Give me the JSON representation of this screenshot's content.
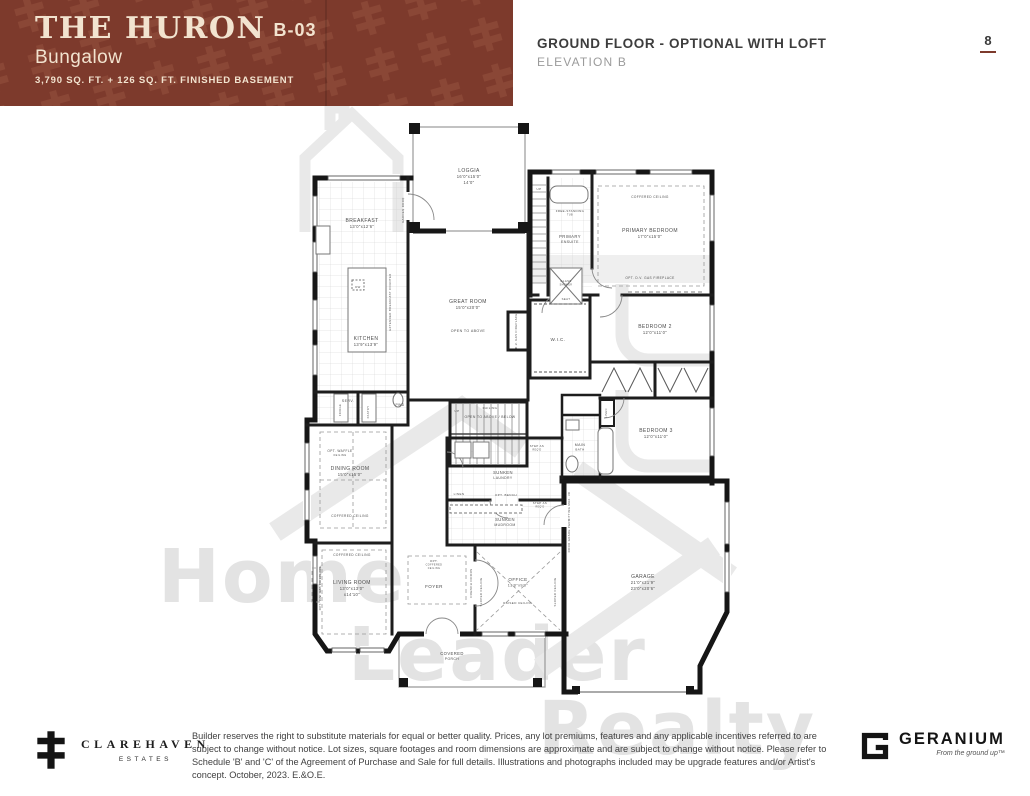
{
  "header": {
    "plan_name": "THE HURON",
    "plan_code": "B-03",
    "plan_type": "Bungalow",
    "sqft_line": "3,790 SQ. FT. + 126 SQ. FT. FINISHED BASEMENT",
    "sheet_title": "GROUND FLOOR - OPTIONAL WITH LOFT",
    "elevation": "ELEVATION B",
    "page_number": "8",
    "banner_color": "#7d3a2c"
  },
  "watermark": {
    "line1": "Home",
    "line2": "Leader",
    "line3": "Realty"
  },
  "floorplan": {
    "labels": [
      {
        "id": "loggia",
        "x": 469,
        "y": 172,
        "size": 5,
        "lines": [
          "LOGGIA",
          "16'0\"x15'0\"",
          "14'0\""
        ]
      },
      {
        "id": "garden-door",
        "x": 404,
        "y": 210,
        "size": 2.8,
        "rot": -90,
        "lines": [
          "GARDEN DOOR"
        ]
      },
      {
        "id": "breakfast",
        "x": 362,
        "y": 222,
        "size": 5,
        "lines": [
          "BREAKFAST",
          "13'0\"x12'6\""
        ]
      },
      {
        "id": "kitchen",
        "x": 366,
        "y": 340,
        "size": 5,
        "lines": [
          "KITCHEN",
          "13'9\"x13'9\""
        ]
      },
      {
        "id": "dw",
        "x": 358,
        "y": 288,
        "size": 2.8,
        "lines": [
          "DW"
        ]
      },
      {
        "id": "extended-counter",
        "x": 391,
        "y": 302,
        "size": 2.8,
        "rot": -90,
        "lines": [
          "EXTENDED BREAKFAST COUNTER"
        ]
      },
      {
        "id": "serv",
        "x": 348,
        "y": 402,
        "size": 3.6,
        "lines": [
          "SERV."
        ]
      },
      {
        "id": "fridge",
        "x": 341,
        "y": 410,
        "size": 2.6,
        "rot": -90,
        "lines": [
          "FRIDGE"
        ]
      },
      {
        "id": "pantry",
        "x": 369,
        "y": 412,
        "size": 2.6,
        "rot": -90,
        "lines": [
          "PANTRY"
        ]
      },
      {
        "id": "pwd",
        "x": 400,
        "y": 406,
        "size": 3.4,
        "lines": [
          "PWD"
        ]
      },
      {
        "id": "great-room",
        "x": 468,
        "y": 303,
        "size": 5,
        "lines": [
          "GREAT ROOM",
          "15'0\"x20'0\""
        ]
      },
      {
        "id": "open-to-above",
        "x": 468,
        "y": 332,
        "size": 3.6,
        "lines": [
          "OPEN TO ABOVE"
        ]
      },
      {
        "id": "dv-gas-fireplace",
        "x": 517,
        "y": 331,
        "size": 2.8,
        "rot": -90,
        "lines": [
          "D.V. GAS FIREPLACE"
        ]
      },
      {
        "id": "up-loft",
        "x": 539,
        "y": 190,
        "size": 3,
        "lines": [
          "UP"
        ]
      },
      {
        "id": "free-standing-tub",
        "x": 570,
        "y": 212,
        "size": 2.9,
        "lines": [
          "FREE-STANDING",
          "TUB"
        ]
      },
      {
        "id": "primary-ensuite",
        "x": 570,
        "y": 238,
        "size": 4.2,
        "lines": [
          "PRIMARY",
          "ENSUITE"
        ]
      },
      {
        "id": "glass-shower",
        "x": 566,
        "y": 282,
        "size": 2.8,
        "lines": [
          "GLASS",
          "SHOWER"
        ]
      },
      {
        "id": "seat",
        "x": 566,
        "y": 300,
        "size": 2.8,
        "lines": [
          "SEAT"
        ]
      },
      {
        "id": "coffered-primary",
        "x": 650,
        "y": 198,
        "size": 3.2,
        "lines": [
          "COFFERED CEILING"
        ]
      },
      {
        "id": "primary-bedroom",
        "x": 650,
        "y": 232,
        "size": 5,
        "lines": [
          "PRIMARY BEDROOM",
          "17'0\"x15'0\""
        ]
      },
      {
        "id": "opt-fireplace-primary",
        "x": 650,
        "y": 279,
        "size": 3.2,
        "lines": [
          "OPT. D.V. GAS FIREPLACE"
        ]
      },
      {
        "id": "wic",
        "x": 558,
        "y": 341,
        "size": 4.6,
        "lines": [
          "W.I.C."
        ]
      },
      {
        "id": "bedroom-2",
        "x": 655,
        "y": 328,
        "size": 5,
        "lines": [
          "BEDROOM 2",
          "12'0\"x11'0\""
        ]
      },
      {
        "id": "bedroom-3",
        "x": 656,
        "y": 432,
        "size": 5,
        "lines": [
          "BEDROOM 3",
          "12'0\"x11'0\""
        ]
      },
      {
        "id": "main-bath",
        "x": 580,
        "y": 446,
        "size": 3.6,
        "lines": [
          "MAIN",
          "BATH"
        ]
      },
      {
        "id": "linen-hall",
        "x": 607,
        "y": 413,
        "size": 2.6,
        "rot": -90,
        "lines": [
          "LINEN"
        ]
      },
      {
        "id": "up-stairs",
        "x": 457,
        "y": 412,
        "size": 3,
        "lines": [
          "UP"
        ]
      },
      {
        "id": "railing",
        "x": 490,
        "y": 409,
        "size": 3,
        "lines": [
          "RAILING"
        ]
      },
      {
        "id": "open-above-below",
        "x": 490,
        "y": 418,
        "size": 3.4,
        "lines": [
          "OPEN TO ABOVE / BELOW"
        ]
      },
      {
        "id": "opt-waffle",
        "x": 340,
        "y": 452,
        "size": 3.2,
        "lines": [
          "OPT. WAFFLE",
          "CEILING"
        ]
      },
      {
        "id": "dining-room",
        "x": 350,
        "y": 470,
        "size": 5,
        "lines": [
          "DINING ROOM",
          "15'0\"x15'0\""
        ]
      },
      {
        "id": "coffered-dining",
        "x": 350,
        "y": 517,
        "size": 3.2,
        "lines": [
          "COFFERED CEILING"
        ]
      },
      {
        "id": "sunken-laundry",
        "x": 503,
        "y": 474,
        "size": 4.2,
        "lines": [
          "SUNKEN",
          "LAUNDRY"
        ]
      },
      {
        "id": "linen-laundry",
        "x": 459,
        "y": 495,
        "size": 3,
        "lines": [
          "LINEN"
        ]
      },
      {
        "id": "opt-bench",
        "x": 506,
        "y": 496,
        "size": 3,
        "lines": [
          "OPT. BENCH"
        ]
      },
      {
        "id": "step-reqd-1",
        "x": 537,
        "y": 447,
        "size": 2.8,
        "lines": [
          "STEP AS",
          "REQ'D"
        ]
      },
      {
        "id": "step-reqd-2",
        "x": 540,
        "y": 504,
        "size": 2.8,
        "lines": [
          "STEP AS",
          "REQ'D"
        ]
      },
      {
        "id": "sunken-mudroom",
        "x": 505,
        "y": 521,
        "size": 4.2,
        "lines": [
          "SUNKEN",
          "MUDROOM"
        ]
      },
      {
        "id": "coffered-living",
        "x": 352,
        "y": 556,
        "size": 3.2,
        "lines": [
          "COFFERED CEILING"
        ]
      },
      {
        "id": "living-room",
        "x": 352,
        "y": 584,
        "size": 5,
        "lines": [
          "LIVING ROOM",
          "13'0\"x13'0\"",
          "x14'10\""
        ]
      },
      {
        "id": "opt-fireplace-living",
        "x": 321,
        "y": 588,
        "size": 2.8,
        "rot": -90,
        "lines": [
          "OPT. D.V. GAS FIREPLACE"
        ]
      },
      {
        "id": "opt-coffered-foyer",
        "x": 434,
        "y": 562,
        "size": 3,
        "lines": [
          "OPT.",
          "COFFERED",
          "CEILING"
        ]
      },
      {
        "id": "foyer",
        "x": 434,
        "y": 588,
        "size": 4.6,
        "lines": [
          "FOYER"
        ]
      },
      {
        "id": "french-doors",
        "x": 472,
        "y": 583,
        "size": 3,
        "rot": -90,
        "lines": [
          "FRENCH DOORS"
        ]
      },
      {
        "id": "office",
        "x": 518,
        "y": 581,
        "size": 4.6,
        "lines": [
          "OFFICE",
          "13'0\"x9'0\""
        ]
      },
      {
        "id": "raised-ceiling",
        "x": 518,
        "y": 604,
        "size": 3,
        "lines": [
          "RAISED CEILING"
        ]
      },
      {
        "id": "sloped-ceiling-1",
        "x": 482,
        "y": 592,
        "size": 2.8,
        "rot": -90,
        "lines": [
          "SLOPED CEILING"
        ]
      },
      {
        "id": "sloped-ceiling-2",
        "x": 556,
        "y": 592,
        "size": 2.8,
        "rot": -90,
        "lines": [
          "SLOPED CEILING"
        ]
      },
      {
        "id": "covered-porch",
        "x": 452,
        "y": 655,
        "size": 4.2,
        "lines": [
          "COVERED",
          "PORCH"
        ]
      },
      {
        "id": "garage",
        "x": 643,
        "y": 578,
        "size": 5,
        "lines": [
          "GARAGE",
          "21'0\"x21'9\"",
          "23'0\"x20'6\""
        ]
      },
      {
        "id": "door-grade",
        "x": 570,
        "y": 522,
        "size": 2.8,
        "rot": -90,
        "lines": [
          "DOOR GRADE PERMITTING MAX. 3R"
        ]
      }
    ]
  },
  "footer": {
    "clarehaven_name": "CLAREHAVEN",
    "clarehaven_sub": "ESTATES",
    "disclaimer": "Builder reserves the right to substitute materials for equal or better quality. Prices, any lot premiums, features and any applicable incentives referred to are subject to change without notice. Lot sizes, square footages and room dimensions are approximate and are subject to change without notice. Please refer to Schedule 'B' and 'C' of the Agreement of Purchase and Sale for full details. Illustrations and photographs included may be upgrade features and/or Artist's concept. October, 2023. E.&O.E.",
    "geranium_name": "GERANIUM",
    "geranium_tagline": "From the ground up™"
  }
}
